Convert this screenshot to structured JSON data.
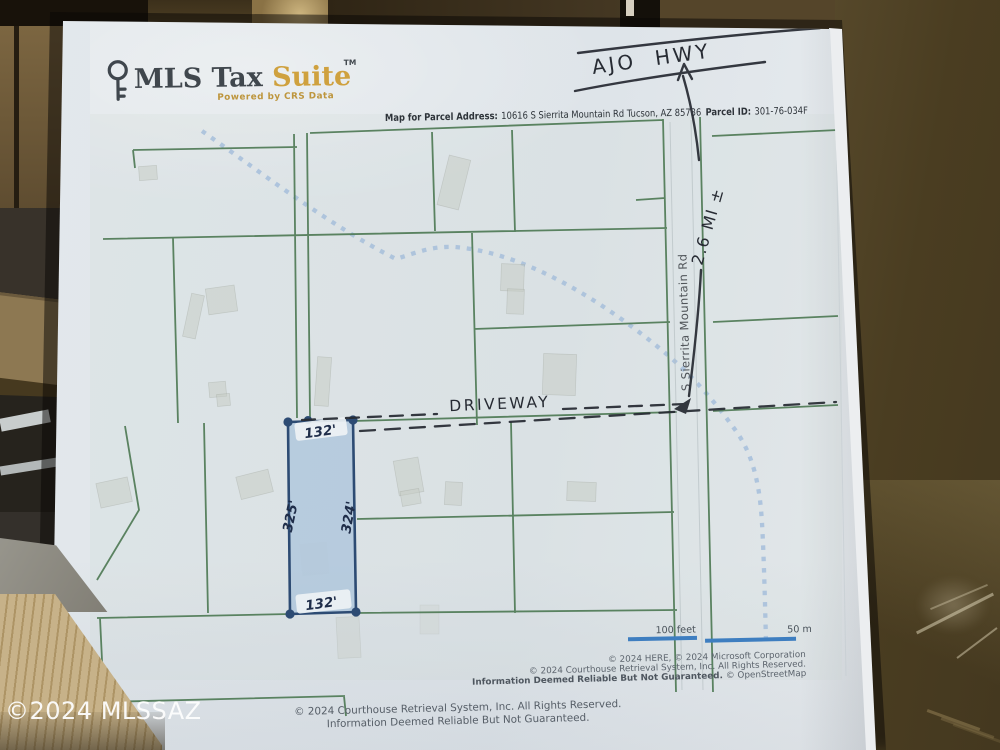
{
  "watermark": "©2024 MLSSAZ",
  "logo": {
    "brand": "MLS Tax ",
    "suite": "Suite",
    "tm": "TM",
    "tagline": "Powered by CRS Data"
  },
  "header": {
    "address_label": "Map for Parcel Address:",
    "address_value": "10616 S Sierrita Mountain Rd Tucson, AZ 85736",
    "parcel_id_label": "Parcel ID:",
    "parcel_id_value": "301-76-034F"
  },
  "map": {
    "road_label": "S Sierrita Mountain Rd",
    "scale": {
      "feet": "100 feet",
      "meters": "50 m"
    },
    "parcel": {
      "dim_top": "132'",
      "dim_left": "325'",
      "dim_right": "324'",
      "dim_bottom": "132'"
    },
    "credits": {
      "line1": "© 2024 HERE, © 2024 Microsoft Corporation",
      "line2": "© 2024 Courthouse Retrieval System, Inc. All Rights Reserved.",
      "line3_bold": "Information Deemed Reliable But Not Guaranteed.",
      "line3_tail": "© OpenStreetMap"
    }
  },
  "annotations": {
    "highway": "AJO HWY",
    "distance": "2.6 MI ±",
    "driveway": "DRIVEWAY"
  },
  "footer": {
    "line1": "© 2024 Courthouse Retrieval System, Inc. All Rights Reserved.",
    "line2": "Information Deemed Reliable But Not Guaranteed."
  },
  "colors": {
    "parcel_line_green": "#4e7a55",
    "subject_parcel_border": "#2d4b73",
    "subject_parcel_fill": "#9fbdd8",
    "wash_blue": "#a6bedb",
    "scale_bar_blue": "#3e7ec0",
    "brand_gold": "#cfa13e",
    "ink": "#272b33"
  }
}
